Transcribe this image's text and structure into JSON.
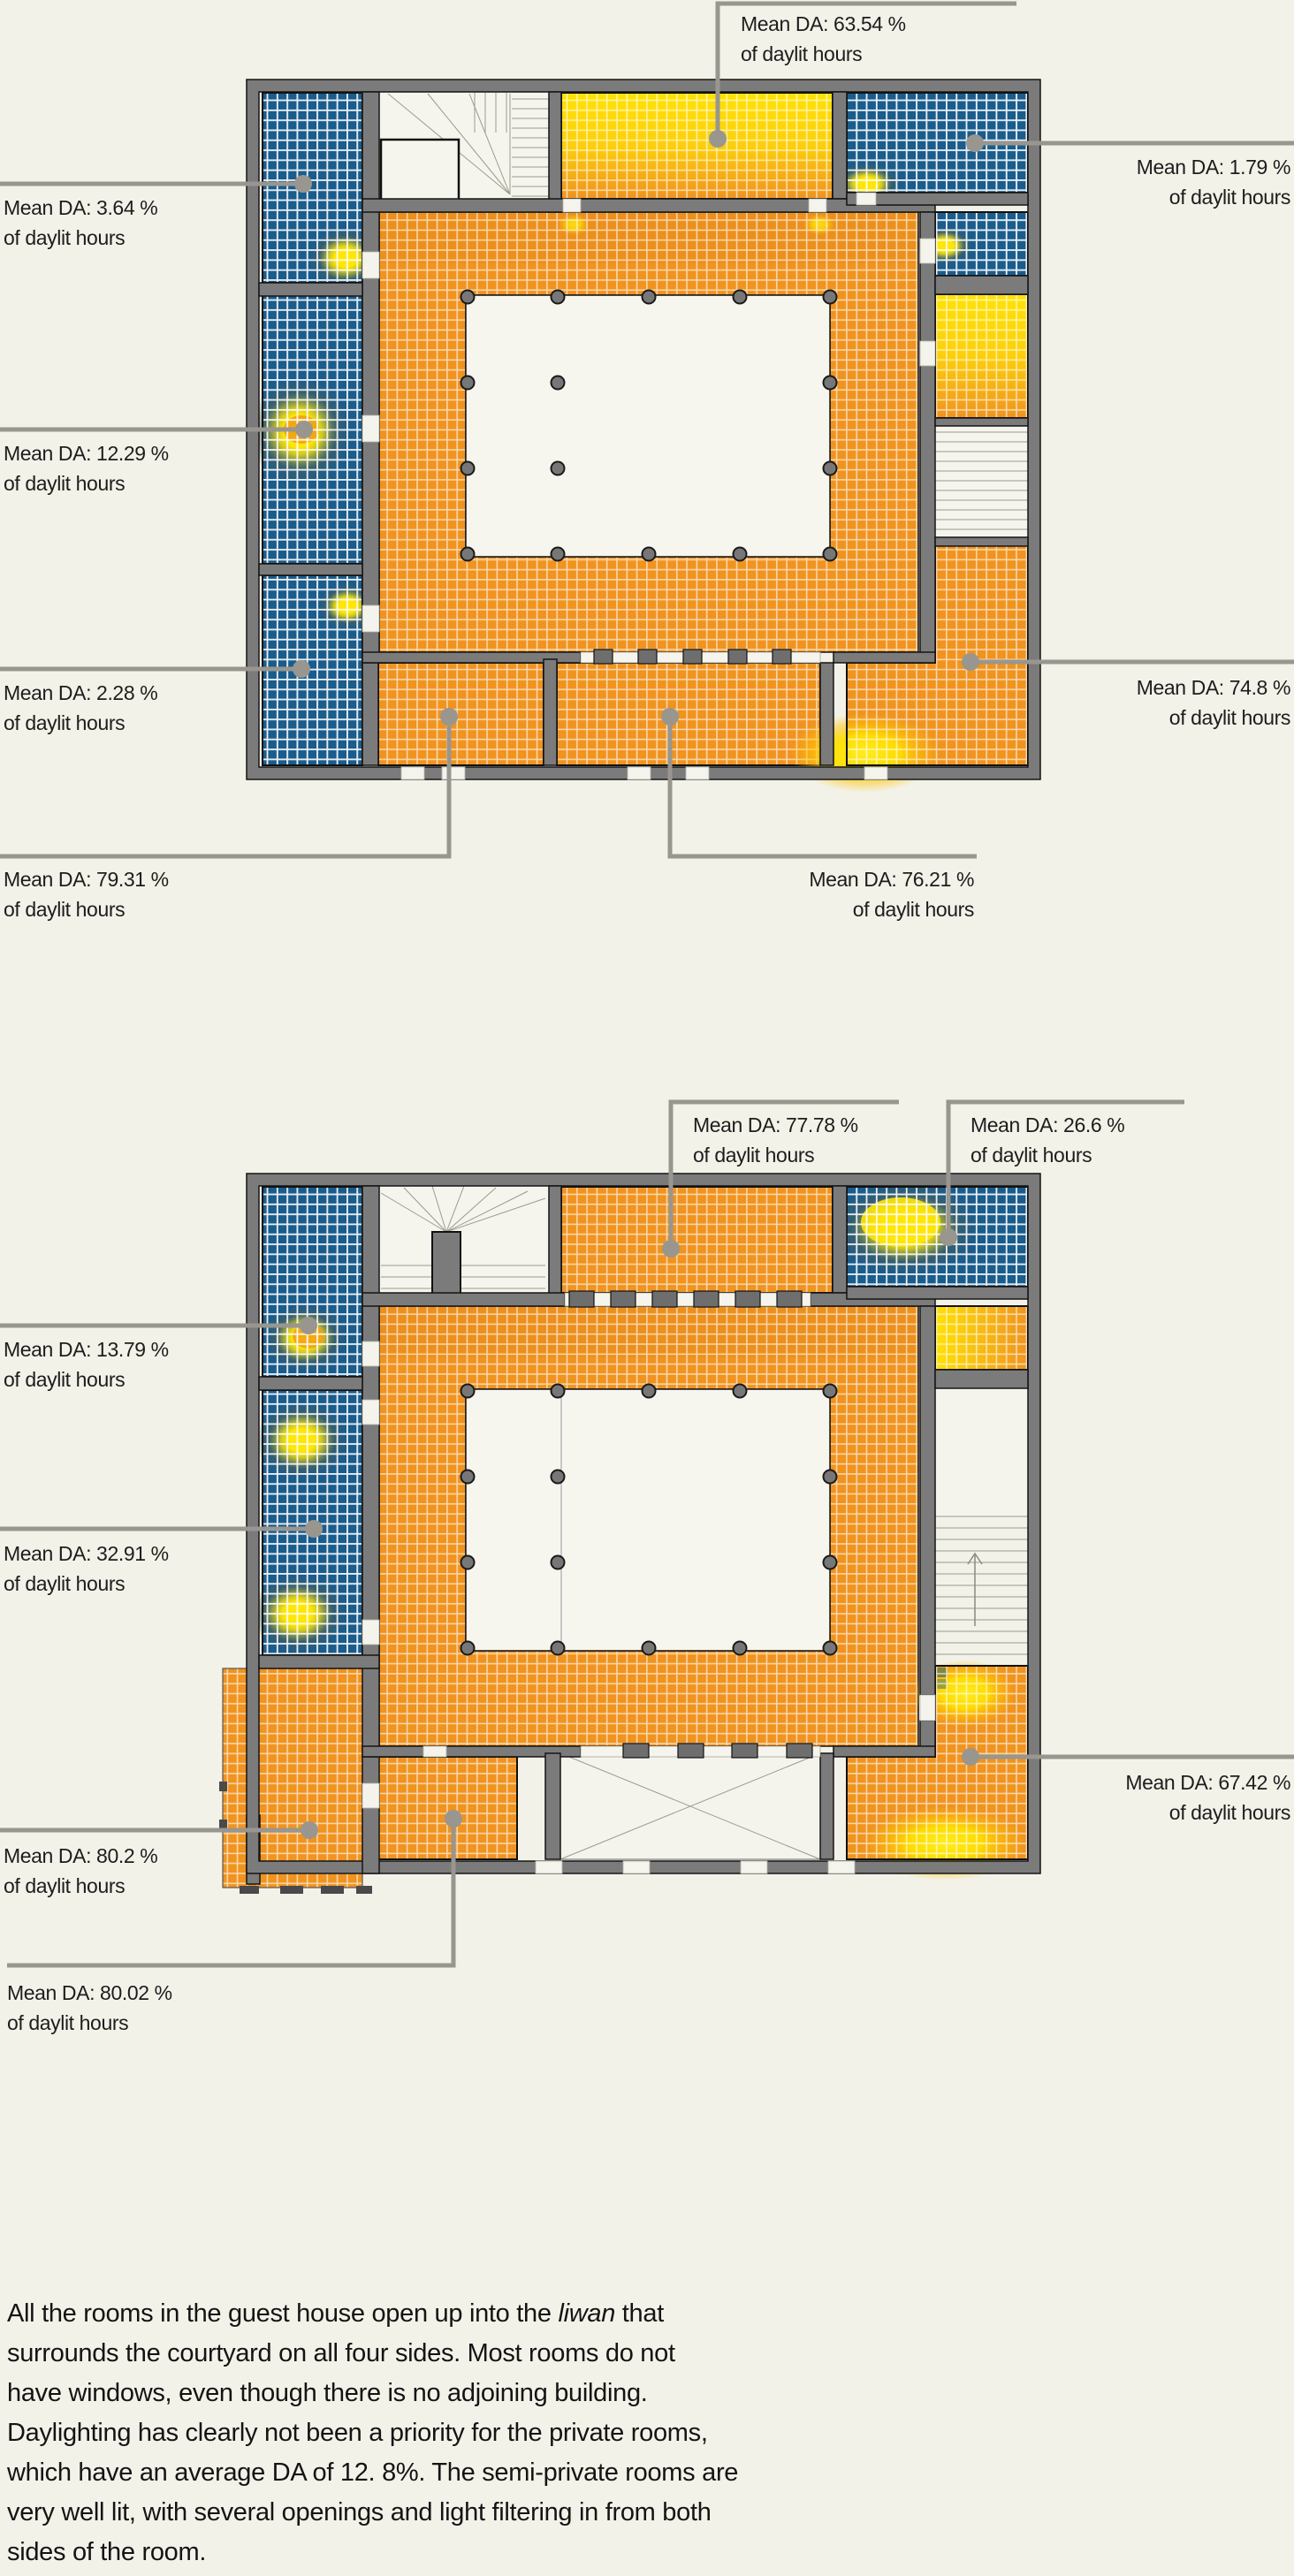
{
  "figure": {
    "annotation_suffix": "of daylit hours",
    "plans": [
      {
        "id": "plan-upper",
        "annotations": [
          {
            "text": "Mean DA: 63.54 %",
            "value": 63.54
          },
          {
            "text": "Mean DA: 1.79 %",
            "value": 1.79
          },
          {
            "text": "Mean DA: 3.64 %",
            "value": 3.64
          },
          {
            "text": "Mean DA: 12.29 %",
            "value": 12.29
          },
          {
            "text": "Mean DA: 2.28 %",
            "value": 2.28
          },
          {
            "text": "Mean DA: 79.31 %",
            "value": 79.31
          },
          {
            "text": "Mean DA: 76.21 %",
            "value": 76.21
          },
          {
            "text": "Mean DA: 74.8 %",
            "value": 74.8
          }
        ]
      },
      {
        "id": "plan-lower",
        "annotations": [
          {
            "text": "Mean DA: 77.78 %",
            "value": 77.78
          },
          {
            "text": "Mean DA: 26.6 %",
            "value": 26.6
          },
          {
            "text": "Mean DA: 13.79 %",
            "value": 13.79
          },
          {
            "text": "Mean DA: 32.91 %",
            "value": 32.91
          },
          {
            "text": "Mean DA: 80.2 %",
            "value": 80.2
          },
          {
            "text": "Mean DA: 80.02 %",
            "value": 80.02
          },
          {
            "text": "Mean DA: 67.42 %",
            "value": 67.42
          }
        ]
      }
    ],
    "caption": {
      "line1_pre": "All the rooms in the guest house open up into the ",
      "line1_italic": "liwan",
      "line1_post": " that",
      "lines": [
        "surrounds the courtyard on all four sides. Most rooms do not",
        "have windows, even though there is no adjoining building.",
        "Daylighting has clearly not been a priority for the private rooms,",
        "which have an average DA of 12. 8%. The semi-private rooms are",
        "very well lit, with several openings and light filtering in from both",
        "sides of the room."
      ]
    },
    "colors": {
      "background": "#f3f2e9",
      "wall_gray": "#7b7b7b",
      "low_da_blue": "#1a5c8c",
      "high_da_orange": "#f0931f",
      "peak_yellow": "#ffe100",
      "leader_gray": "#98968f"
    }
  }
}
